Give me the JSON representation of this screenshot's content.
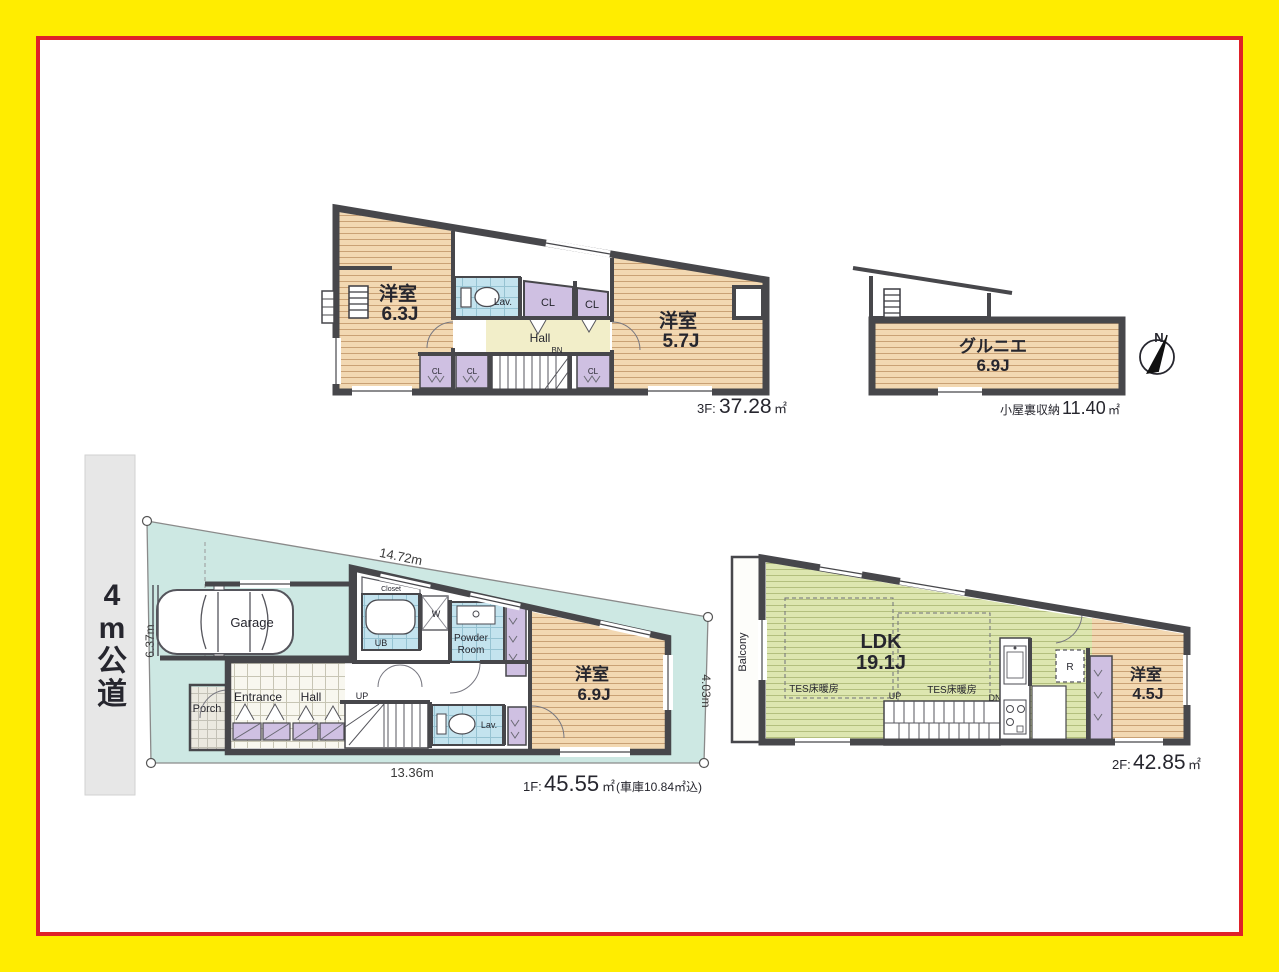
{
  "compass": {
    "north_label": "N"
  },
  "plan_3f": {
    "room_west": {
      "name": "洋室",
      "size": "6.3J"
    },
    "room_east": {
      "name": "洋室",
      "size": "5.7J"
    },
    "lav_label": "Lav.",
    "closet_labels": [
      "CL",
      "CL",
      "CL",
      "CL",
      "CL"
    ],
    "hall_label": "Hall",
    "bn_label": "BN",
    "area": {
      "prefix": "3F:",
      "value": "37.28",
      "unit": "㎡"
    }
  },
  "attic": {
    "room": {
      "name": "グルニエ",
      "size": "6.9J"
    },
    "area": {
      "prefix": "小屋裏収納",
      "value": "11.40",
      "unit": "㎡"
    }
  },
  "site": {
    "road_label_chars": [
      "4",
      "m",
      "公",
      "道"
    ],
    "dim_top": "14.72m",
    "dim_left": "6.37m",
    "dim_bottom": "13.36m",
    "dim_right": "4.03m"
  },
  "plan_1f": {
    "garage_label": "Garage",
    "closet_label": "Closet",
    "ub_label": "UB",
    "washer_label": "W",
    "powder_line1": "Powder",
    "powder_line2": "Room",
    "lav_label": "Lav.",
    "entrance_label": "Entrance",
    "hall_label": "Hall",
    "porch_label": "Porch",
    "up_label": "UP",
    "room": {
      "name": "洋室",
      "size": "6.9J"
    },
    "area": {
      "prefix": "1F:",
      "value": "45.55",
      "unit": "㎡",
      "note": "(車庫10.84㎡込)"
    }
  },
  "plan_2f": {
    "balcony_label": "Balcony",
    "ldk": {
      "name": "LDK",
      "size": "19.1J"
    },
    "floor_heating_left": "TES床暖房",
    "floor_heating_right": "TES床暖房",
    "up_label": "UP",
    "dn_label": "DN",
    "fridge_label": "R",
    "room": {
      "name": "洋室",
      "size": "4.5J"
    },
    "area": {
      "prefix": "2F:",
      "value": "42.85",
      "unit": "㎡"
    }
  }
}
